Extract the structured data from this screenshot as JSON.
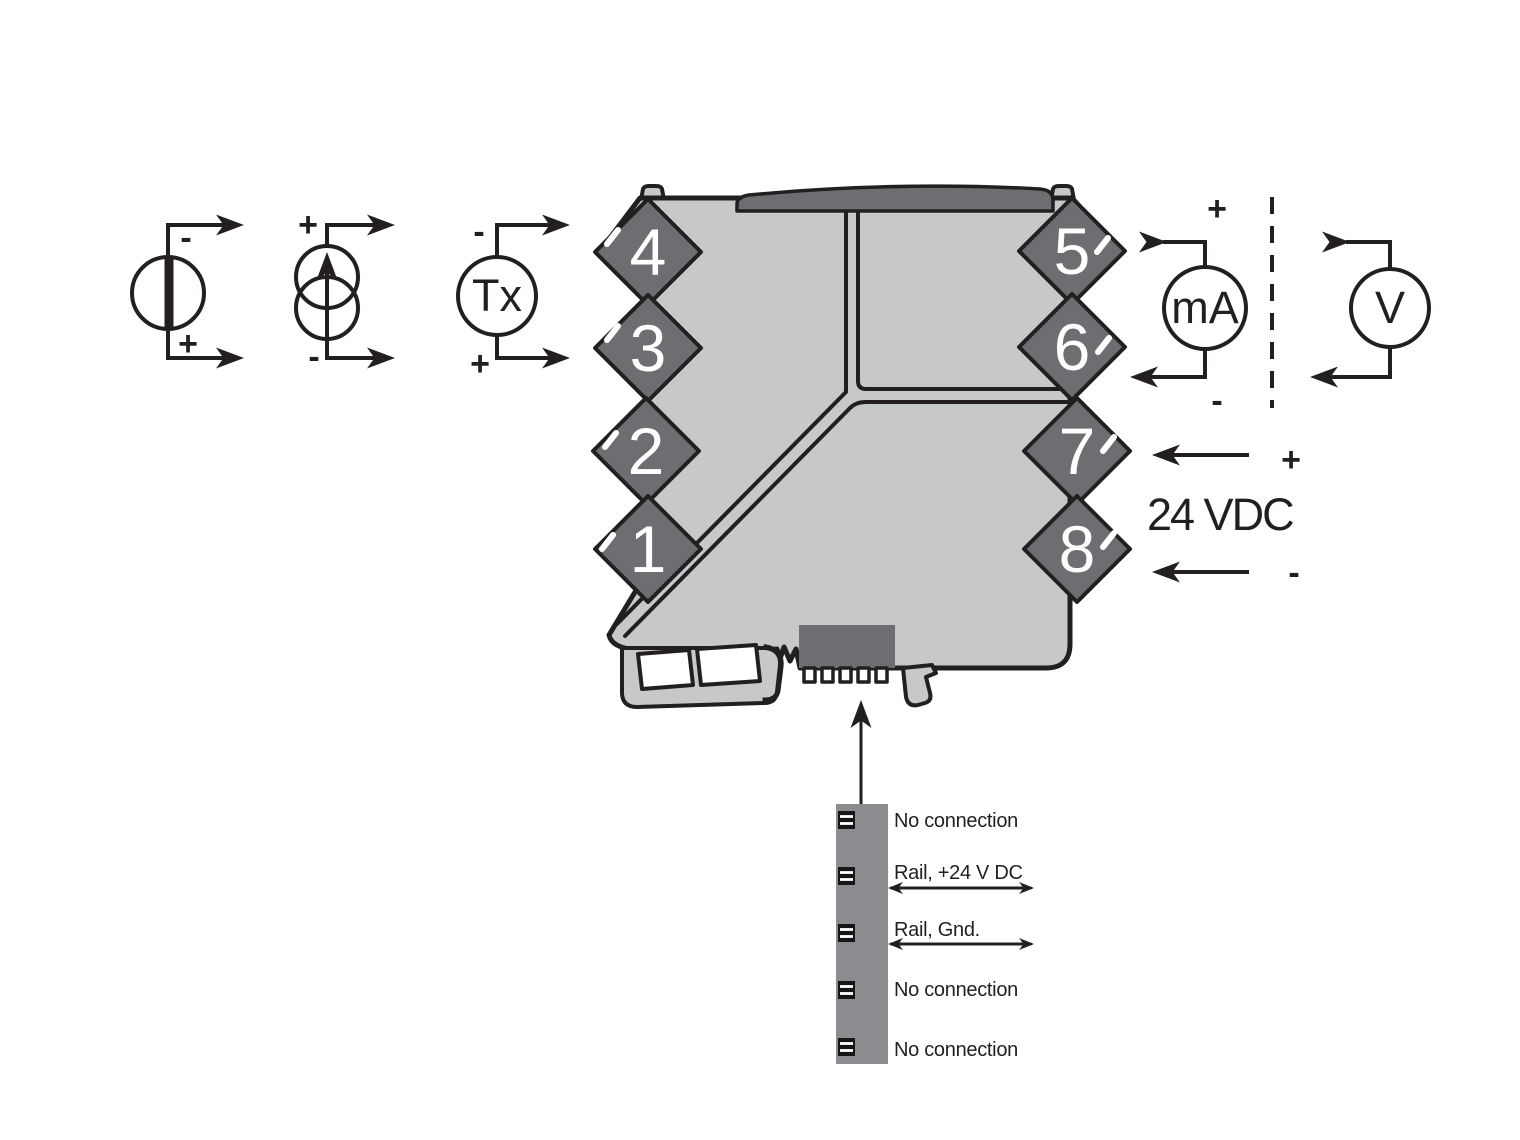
{
  "colors": {
    "module_body": "#c7c8ca",
    "module_dark": "#6d6e71",
    "rail_bar": "#8a8c8f",
    "line": "#231f20"
  },
  "input_symbols": {
    "voltage_source": {
      "top_sign": "-",
      "bottom_sign": "+"
    },
    "current_source": {
      "top_sign": "+",
      "bottom_sign": "-"
    },
    "transmitter": {
      "label": "Tx",
      "top_sign": "-",
      "bottom_sign": "+"
    }
  },
  "module": {
    "terminals_left": [
      "4",
      "3",
      "2",
      "1"
    ],
    "terminals_right": [
      "5",
      "6",
      "7",
      "8"
    ]
  },
  "output_symbols": {
    "current_meter": {
      "label": "mA",
      "top_sign": "+",
      "bottom_sign": "-"
    },
    "voltage_meter": {
      "label": "V"
    }
  },
  "power": {
    "plus": "+",
    "label": "24 VDC",
    "minus": "-"
  },
  "rail_connector": {
    "pin_labels": [
      "No connection",
      "Rail, +24 V DC",
      "Rail, Gnd.",
      "No connection",
      "No connection"
    ]
  }
}
